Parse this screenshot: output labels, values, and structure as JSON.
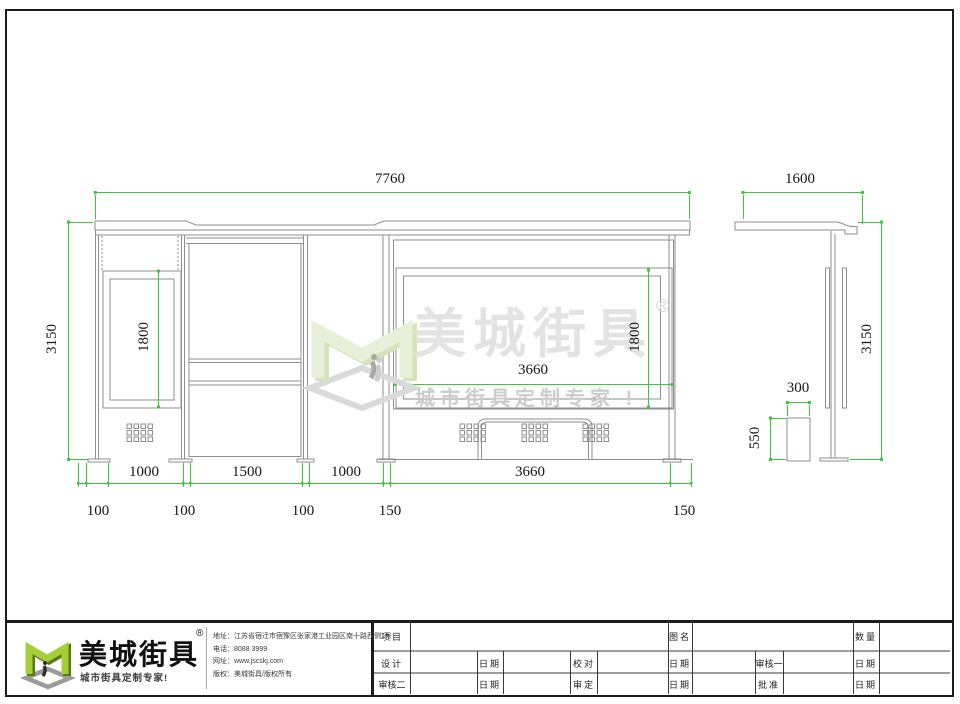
{
  "dimensions": {
    "front": {
      "total_width": "7760",
      "height": "3150",
      "lightbox_height": "1800",
      "panel_width": "3660",
      "panel_height": "1800",
      "bay1": "1000",
      "bay2": "1500",
      "bay3": "1000",
      "bay4": "3660",
      "offsets": [
        "100",
        "100",
        "100",
        "150",
        "150"
      ]
    },
    "side": {
      "roof_width": "1600",
      "height": "3150",
      "bin_width": "300",
      "bin_height": "550"
    }
  },
  "watermark": {
    "brand": "美城街具",
    "registered": "®",
    "tagline": "城市街具定制专家 !"
  },
  "logo": {
    "brand": "美城街具",
    "registered": "®",
    "tagline": "城市街具定制专家!"
  },
  "company": {
    "address": "地址：江苏省宿迁市宿豫区张家港工业园区南十路西侧1号",
    "phone": "电话：8088 3999",
    "website": "网址：www.jscskj.com",
    "copyright": "版权：美城街具/版权所有"
  },
  "titleblock": {
    "project": "项目",
    "drawing_name": "图名",
    "quantity": "数量",
    "design": "设计",
    "date": "日期",
    "proofread": "校对",
    "reviewer1": "审核一",
    "reviewer2": "审核二",
    "approve": "审定",
    "ratify": "批准"
  },
  "colors": {
    "dimension_green": "#3fc43f",
    "line_grey": "#8e8e8e",
    "watermark_grey": "#e3e3e3",
    "logo_green": "#a6ce39"
  }
}
